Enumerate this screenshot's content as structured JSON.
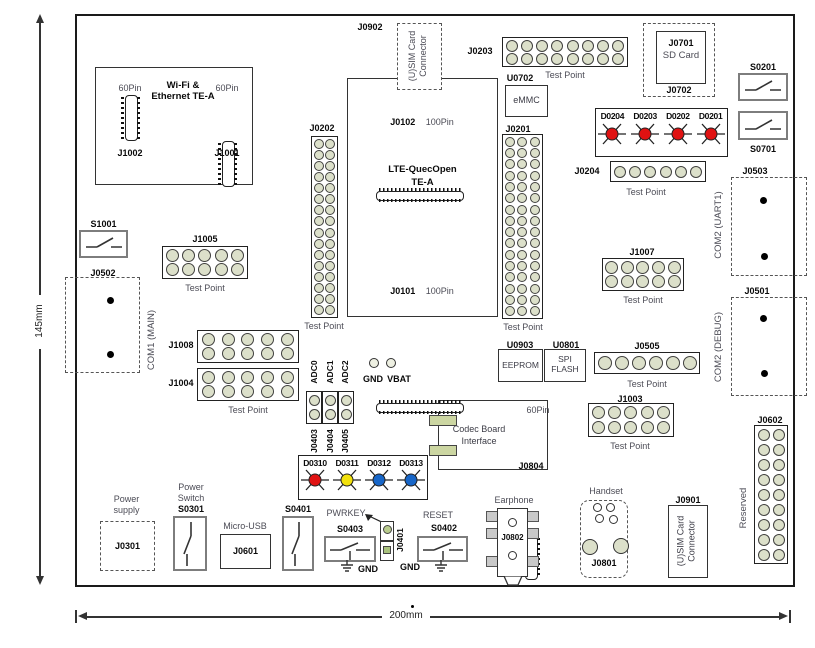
{
  "dims": {
    "height": "145mm",
    "width": "200mm"
  },
  "wifi": {
    "title1": "Wi-Fi &",
    "title2": "Ethernet TE-A",
    "pin_left": "60Pin",
    "ref_left": "J1002",
    "pin_right": "60Pin",
    "ref_right": "J1001"
  },
  "sim_top": {
    "ref": "J0902",
    "line1": "(U)SIM Card",
    "line2": "Connector"
  },
  "j0203": {
    "ref": "J0203",
    "caption": "Test Point",
    "grid": {
      "cols": 8,
      "rows": 2
    }
  },
  "sd": {
    "ref": "J0701",
    "name": "SD Card",
    "outer_ref": "J0702"
  },
  "s0201": {
    "ref": "S0201"
  },
  "s0701": {
    "ref": "S0701"
  },
  "emmc": {
    "ref": "U0702",
    "name": "eMMC"
  },
  "leds_top": {
    "items": [
      {
        "label": "D0204",
        "color": "#e01212"
      },
      {
        "label": "D0203",
        "color": "#e01212"
      },
      {
        "label": "D0202",
        "color": "#e01212"
      },
      {
        "label": "D0201",
        "color": "#e01212"
      }
    ]
  },
  "j0204": {
    "ref": "J0204",
    "caption": "Test Point",
    "grid": {
      "cols": 6,
      "rows": 1
    }
  },
  "module": {
    "top_ref": "J0102",
    "top_pin": "100Pin",
    "title1": "LTE-QuecOpen",
    "title2": "TE-A",
    "bottom_ref": "J0101",
    "bottom_pin": "100Pin"
  },
  "j0202": {
    "ref": "J0202",
    "caption": "Test Point",
    "grid": {
      "cols": 2,
      "rows": 16
    }
  },
  "j0201": {
    "ref": "J0201",
    "caption": "Test Point",
    "grid": {
      "cols": 3,
      "rows": 16
    }
  },
  "s1001": {
    "ref": "S1001"
  },
  "j0502": {
    "ref": "J0502",
    "port": "COM1 (MAIN)"
  },
  "j1005": {
    "ref": "J1005",
    "caption": "Test Point",
    "grid": {
      "cols": 5,
      "rows": 2
    }
  },
  "j1008": {
    "ref": "J1008",
    "grid": {
      "cols": 5,
      "rows": 2
    }
  },
  "j1004": {
    "ref": "J1004",
    "caption": "Test Point",
    "grid": {
      "cols": 5,
      "rows": 2
    }
  },
  "com_uart": {
    "ref": "J0503",
    "port": "COM2 (UART1)"
  },
  "com_debug": {
    "ref": "J0501",
    "port": "COM2 (DEBUG)"
  },
  "adc": {
    "cols": [
      {
        "top": "ADC0",
        "bottom": "J0403",
        "grid": {
          "cols": 1,
          "rows": 2
        }
      },
      {
        "top": "ADC1",
        "bottom": "J0404",
        "grid": {
          "cols": 1,
          "rows": 2
        }
      },
      {
        "top": "ADC2",
        "bottom": "J0405",
        "grid": {
          "cols": 1,
          "rows": 2
        }
      }
    ]
  },
  "power_pads": {
    "gnd": "GND",
    "vbat": "VBAT"
  },
  "leds_mid": {
    "items": [
      {
        "label": "D0310",
        "color": "#e01212"
      },
      {
        "label": "D0311",
        "color": "#f2e10c"
      },
      {
        "label": "D0312",
        "color": "#1766c8"
      },
      {
        "label": "D0313",
        "color": "#1766c8"
      }
    ]
  },
  "codec": {
    "line1": "Codec Board",
    "line2": "Interface",
    "pin": "60Pin",
    "ref": "J0804"
  },
  "eeprom": {
    "ref": "U0903",
    "name": "EEPROM"
  },
  "spiflash": {
    "ref": "U0801",
    "name1": "SPI",
    "name2": "FLASH"
  },
  "j0505": {
    "ref": "J0505",
    "caption": "Test Point",
    "grid": {
      "cols": 6,
      "rows": 1
    }
  },
  "j1007": {
    "ref": "J1007",
    "caption": "Test Point",
    "grid": {
      "cols": 5,
      "rows": 2
    }
  },
  "j1003": {
    "ref": "J1003",
    "caption": "Test Point",
    "grid": {
      "cols": 5,
      "rows": 2
    }
  },
  "j0602": {
    "ref": "J0602",
    "note": "Reserved",
    "grid": {
      "cols": 2,
      "rows": 9
    }
  },
  "power_supply": {
    "label1": "Power",
    "label2": "supply",
    "ref": "J0301"
  },
  "power_switch": {
    "label1": "Power",
    "label2": "Switch",
    "ref": "S0301"
  },
  "microusb": {
    "label": "Micro-USB",
    "ref": "J0601"
  },
  "s0401": {
    "ref": "S0401"
  },
  "pwrkey": {
    "label": "PWRKEY",
    "ref": "S0403",
    "gnd": "GND"
  },
  "j0401": {
    "ref": "J0401"
  },
  "reset": {
    "label": "RESET",
    "ref": "S0402",
    "gnd": "GND"
  },
  "earphone": {
    "label": "Earphone",
    "ref": "J0802"
  },
  "handset": {
    "label": "Handset",
    "ref": "J0801"
  },
  "sim_bottom": {
    "ref": "J0901",
    "line1": "(U)SIM Card",
    "line2": "Connector"
  }
}
